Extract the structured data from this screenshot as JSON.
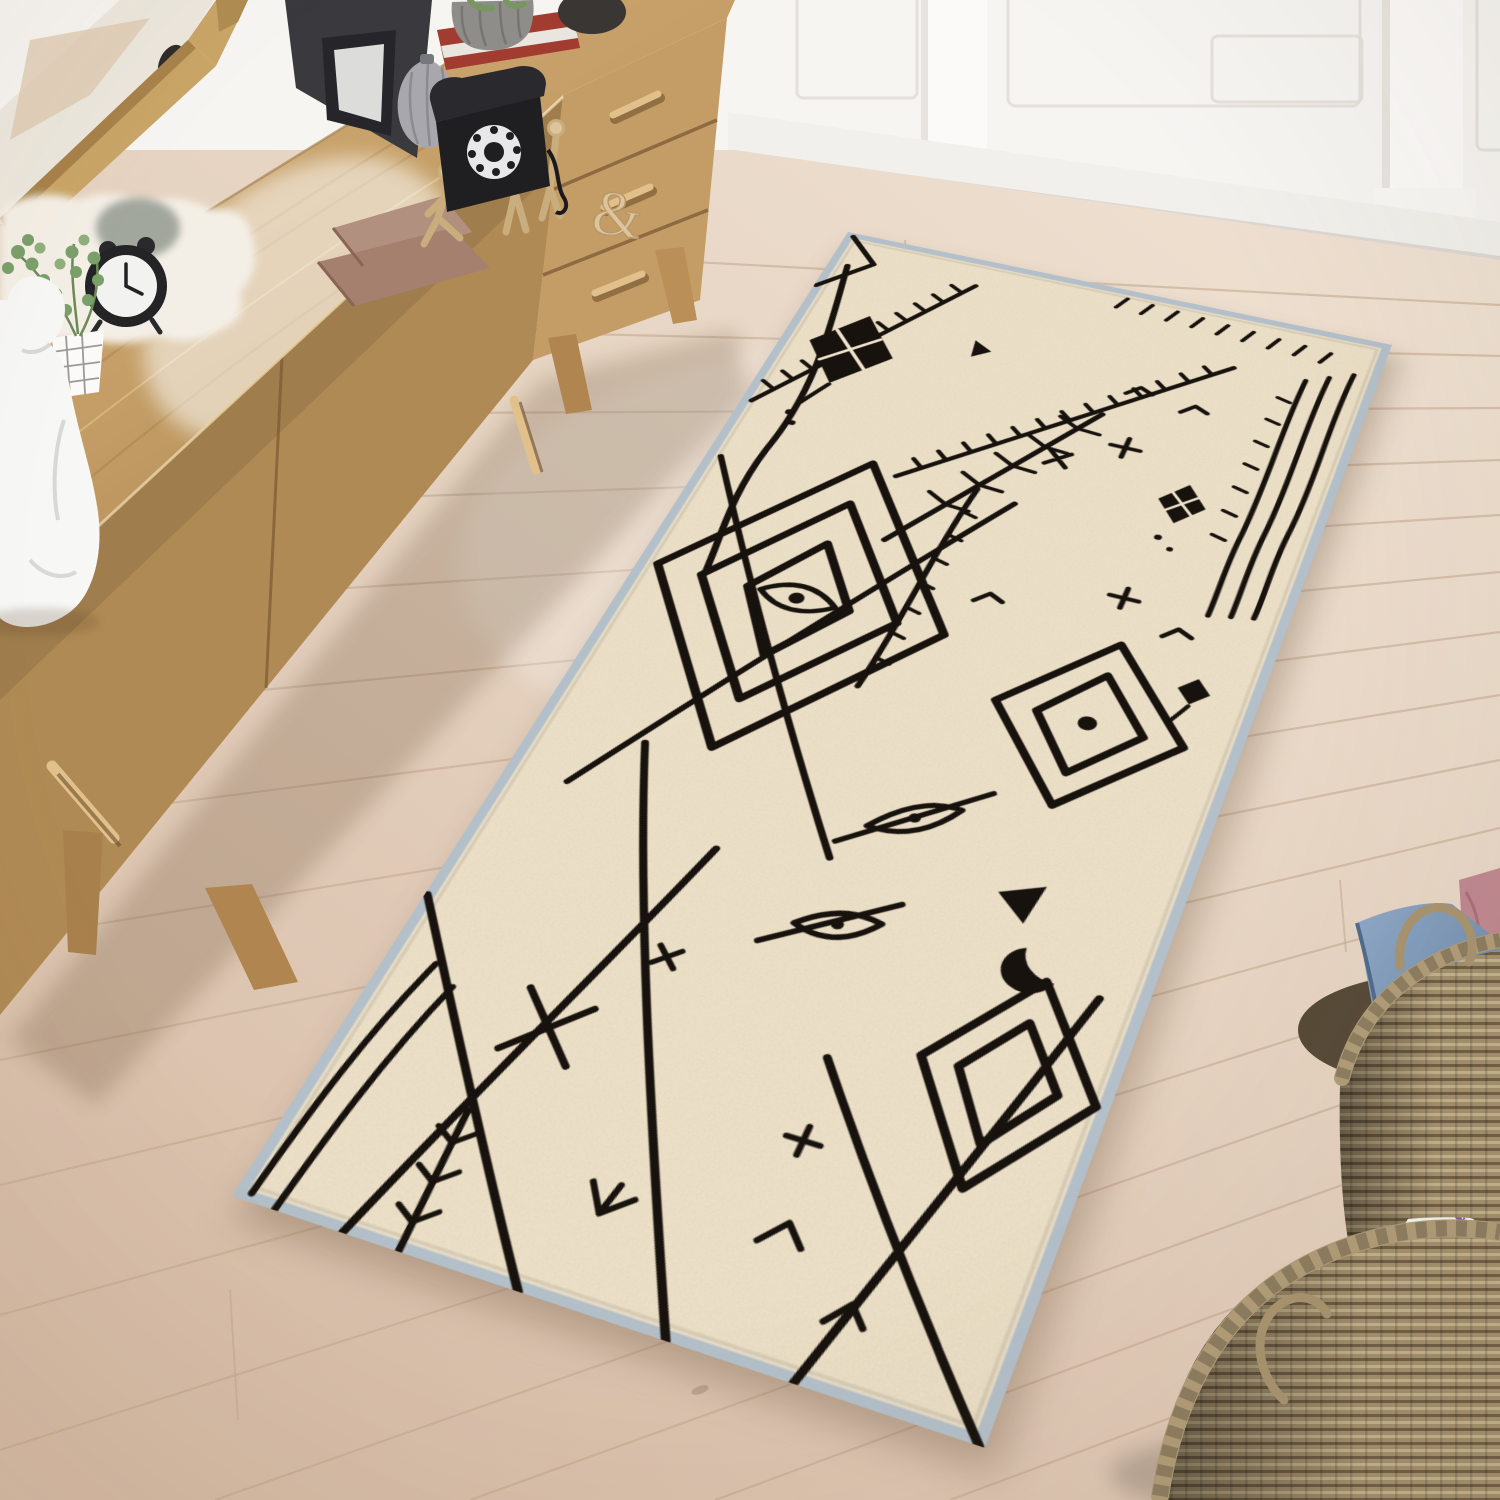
{
  "scene": {
    "description": "Bright interior photo: cream Moroccan berber runner rug with black tribal line pattern lying diagonally on a whitewashed wood plank floor, oak mid-century sideboard with leaning mirror and decor at upper left, white paneled wall behind, wicker baskets with velvet pillows and magazines at lower right",
    "room": {
      "wall": "white paneled wall with pilasters and baseboard",
      "floor": "light whitewashed wood planks laid diagonally"
    },
    "furniture": {
      "sideboard": "light oak sideboard with three drawers, two doors and tapered legs",
      "mirror": "oak-framed mirror leaning on sideboard"
    },
    "decor_items": [
      "white kneeling bust sculpture",
      "eucalyptus plant in white grid pot",
      "black twin-bell alarm clock",
      "grey dried-flower bunch",
      "faux sheepskin throw",
      "stacked wooden boxes",
      "wooden artist mannequins",
      "wooden ampersand letter",
      "black leaning picture frames",
      "silver gourd vase",
      "black rotary telephone",
      "succulent in ribbed grey pot on red book"
    ],
    "rug": {
      "style": "Moroccan berber runner",
      "base": "cream with woven texture",
      "pattern": "hand-drawn black diamonds, blanket stitches, kites, branches and tribal symbols",
      "binding": "pale blue-grey edge"
    },
    "baskets": {
      "pillow_basket": [
        "blue velvet pillow",
        "rose velvet pillow",
        "striped pillow"
      ],
      "magazine_basket": {
        "magazine_title": "VERANDA",
        "note": "title appears mirrored in photo"
      }
    },
    "colors": {
      "wall": "#f6f5f2",
      "baseboard": "#efeeea",
      "floor_light": "#eedfd0",
      "floor_dark": "#d7bca6",
      "floor_seam": "#c2a68e",
      "wood_light": "#cfa972",
      "wood_mid": "#b78f58",
      "wood_dark": "#8a6436",
      "handle_wood": "#dfbe8c",
      "rug_base": "#efe3cb",
      "rug_ink": "#17120d",
      "rug_binding": "#b3bfc9",
      "basket": "#a08d6c",
      "basket_dark": "#6f5f46",
      "pillow_blue": "#7e9cc0",
      "pillow_rose": "#c08891",
      "pillow_stripe": "#7fae9f",
      "plant_green": "#76975f",
      "bust": "#f7f7f6",
      "phone": "#1f1f22",
      "clock_black": "#242426",
      "vase_silver": "#a7a7ad",
      "sheepskin": "#f4efe6",
      "mannequin": "#dcc49c",
      "frame_dark": "#3a3a3e",
      "box_brown": "#ad8a7a",
      "magazine_purple": "#8a4fae"
    }
  }
}
